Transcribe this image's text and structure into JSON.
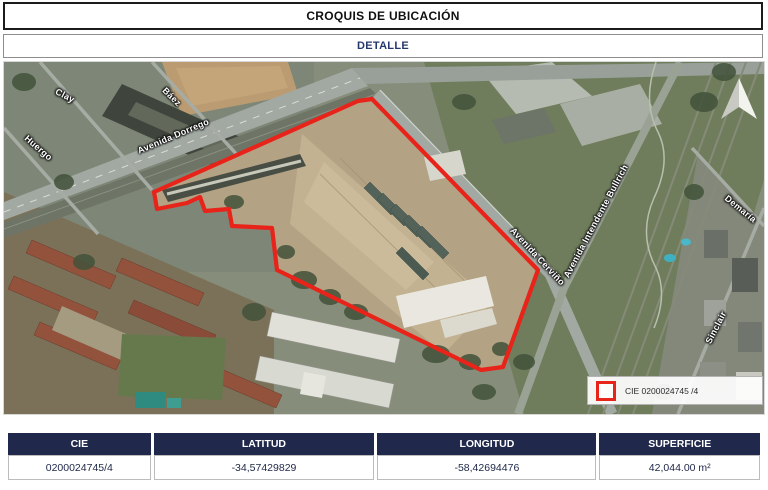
{
  "header": {
    "title": "CROQUIS DE UBICACIÓN",
    "subtitle": "DETALLE"
  },
  "map": {
    "street_labels": [
      {
        "text": "Clay"
      },
      {
        "text": "Báez"
      },
      {
        "text": "Huergo"
      },
      {
        "text": "Avenida Dorrego"
      },
      {
        "text": "Avenida Cerviño"
      },
      {
        "text": "Avenida Intendente Bullrich"
      },
      {
        "text": "Demaría"
      },
      {
        "text": "Sinclair"
      }
    ],
    "legend": {
      "label": "CIE 0200024745 /4"
    },
    "parcel_outline_color": "#e8231a"
  },
  "table": {
    "columns": [
      "CIE",
      "LATITUD",
      "LONGITUD",
      "SUPERFICIE"
    ],
    "rows": [
      [
        "0200024745/4",
        "-34,57429829",
        "-58,42694476",
        "42,044.00 m²"
      ]
    ]
  },
  "colors": {
    "header_navy": "#20294b",
    "subtitle_navy": "#25386e",
    "parcel_red": "#e8231a"
  }
}
